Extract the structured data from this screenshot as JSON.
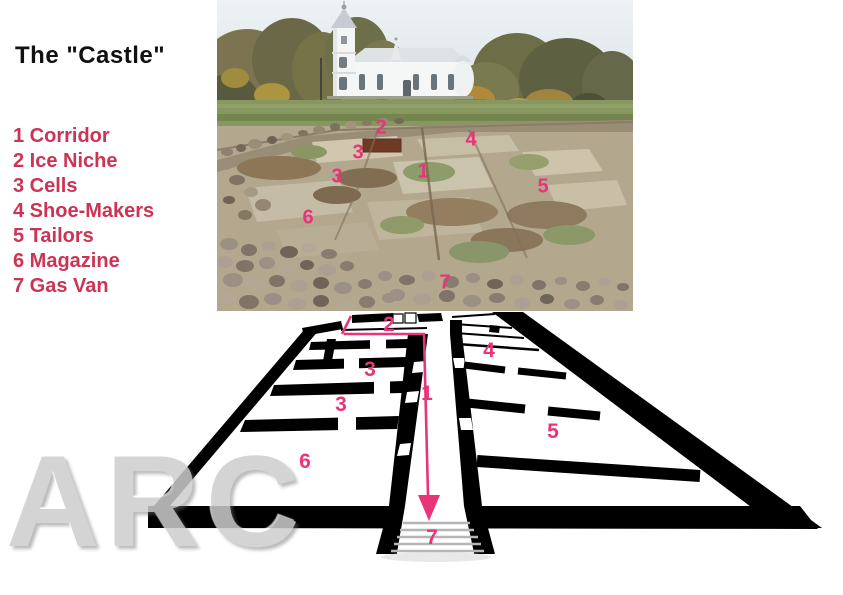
{
  "colors": {
    "legend_red": "#cc3355",
    "accent_pink": "#e8357a",
    "watermark_gray": "#cdcdcd",
    "title_color": "#111111",
    "wall_black": "#000000",
    "background": "#ffffff"
  },
  "title": "The \"Castle\"",
  "legend": {
    "items": [
      "1 Corridor",
      "2 Ice Niche",
      "3 Cells",
      "4 Shoe-Makers",
      "5 Tailors",
      "6 Magazine",
      "7 Gas Van"
    ]
  },
  "photo": {
    "labels": [
      "2",
      "3",
      "4",
      "1",
      "3",
      "5",
      "6",
      "7"
    ]
  },
  "plan": {
    "labels": [
      "2",
      "4",
      "3",
      "1",
      "3",
      "5",
      "6",
      "7"
    ]
  },
  "watermark": "ARC"
}
